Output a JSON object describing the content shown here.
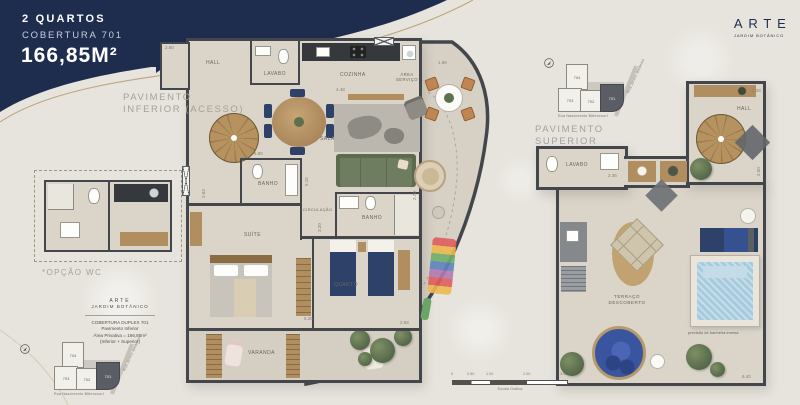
{
  "colors": {
    "navy": "#1e2c4e",
    "gold": "#b59b6f",
    "wall": "#43464b",
    "floor": "#dad4c9",
    "terrace": "#d7d1c5",
    "wood": "#b08e5f",
    "woodDark": "#8a6c42",
    "green": "#6e7d5f",
    "pool": "#a7cbde",
    "bednavy": "#2e4168",
    "counter": "#35383c",
    "graycounter": "#85898c"
  },
  "header": {
    "rooms": "2 QUARTOS",
    "unit": "COBERTURA 701",
    "area": "166,85M²"
  },
  "brand": {
    "name": "ARTE",
    "tagline": "JARDIM BOTÂNICO"
  },
  "lower": {
    "title_l1": "PAVIMENTO",
    "title_l2": "INFERIOR (ACESSO)",
    "rooms": {
      "hall": "HALL",
      "lavabo": "LAVABO",
      "cozinha": "COZINHA",
      "area_servico": "ÁREA SERVIÇO",
      "sala": "SALA",
      "banho1": "BANHO",
      "circulacao": "CIRCULAÇÃO",
      "banho2": "BANHO",
      "suite": "SUÍTE",
      "quarto": "QUARTO",
      "varanda": "VARANDA"
    },
    "dims": [
      "2.80",
      "4.48",
      "1.98",
      "6.90",
      "2.83",
      "5.15",
      "2.70",
      "3.20",
      "5.20",
      "2.58"
    ]
  },
  "upper": {
    "title_l1": "PAVIMENTO",
    "title_l2": "SUPERIOR",
    "rooms": {
      "lavabo": "LAVABO",
      "hall": "HALL",
      "terraco_l1": "TERRAÇO",
      "terraco_l2": "DESCOBERTO"
    },
    "pool_note": "previsão de banheira imersa",
    "dims": [
      "2.36",
      "2.28",
      "2.50",
      "6.40"
    ]
  },
  "wc_option": {
    "label": "*OPÇÃO WC"
  },
  "info_block": {
    "brand": "ARTE",
    "brand2": "JARDIM BOTÂNICO",
    "l1": "COBERTURA DUPLEX 701",
    "l2": "Pavimento Inferior",
    "l3": "Área Privativa = 166,85m²",
    "l4": "(Inferior + Superior)"
  },
  "keyplan": {
    "units": [
      "704",
      "703",
      "702",
      "701"
    ],
    "street_bottom": "Rua Nascimento Bittencourt",
    "street_right": "Rua Jardim Botânico"
  },
  "scalebar": {
    "ticks": [
      "0",
      "0.50",
      "1.00",
      "2.00",
      "3.00"
    ],
    "caption": "Escala Gráfica"
  }
}
